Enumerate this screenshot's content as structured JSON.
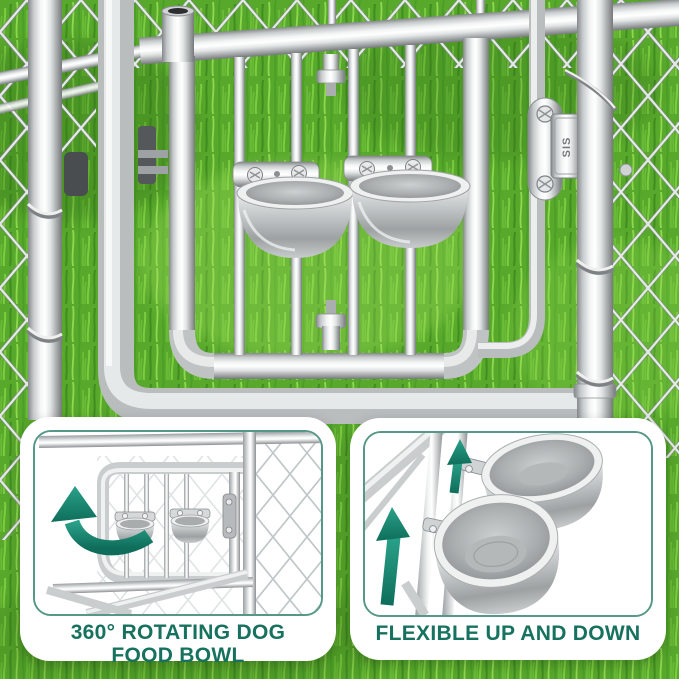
{
  "scene": {
    "description": "Silver metal dog kennel gate with twin stainless-steel food bowls on a rotating feeder door, chain-link fence and green grass background",
    "latch_label": "SIS"
  },
  "callouts": {
    "rotating_bowl": {
      "caption_line1": "360° ROTATING DOG",
      "caption_line2": "FOOD BOWL"
    },
    "flexible": {
      "caption": "FLEXIBLE UP AND DOWN"
    }
  },
  "icons": {
    "rotate_arrow": "curved-rotation-arrow",
    "up_arrow_large": "up-arrow",
    "up_arrow_small": "up-arrow"
  },
  "colors": {
    "caption_teal": "#17715F",
    "arrow_teal_light": "#2AA189",
    "arrow_teal_dark": "#0E6E5B",
    "inner_border_teal": "#569887",
    "grass_green": "#58A82C",
    "metal_silver": "#C9CDCE",
    "card_background": "#FFFFFF"
  }
}
